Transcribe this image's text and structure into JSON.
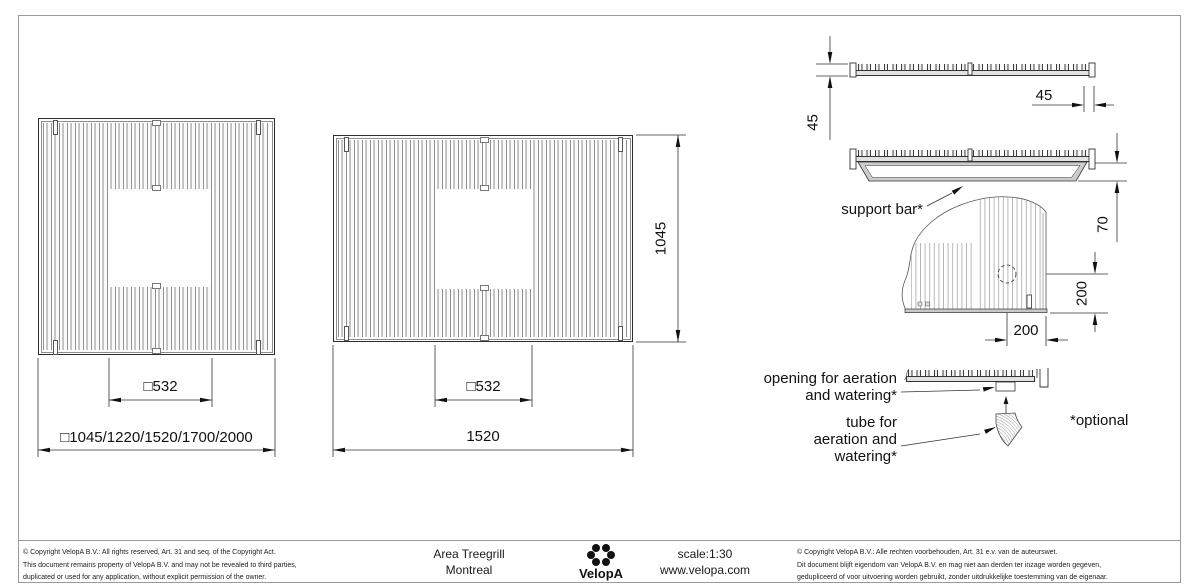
{
  "drawing": {
    "square_grill": {
      "inner_dim": "□532",
      "outer_dim": "□1045/1220/1520/1700/2000"
    },
    "rect_grill": {
      "inner_dim": "□532",
      "width_dim": "1520",
      "height_dim": "1045"
    },
    "profile": {
      "height_dim": "45",
      "edge_dim": "45",
      "assembly_height_dim": "70",
      "support_label": "support bar*"
    },
    "corner_detail": {
      "vertical_dim": "200",
      "horizontal_dim": "200"
    },
    "aeration_detail": {
      "opening_label_lines": [
        "opening for aeration",
        "and watering*"
      ],
      "tube_label_lines": [
        "tube for",
        "aeration and",
        "watering*"
      ],
      "optional_note": "*optional"
    }
  },
  "title_block": {
    "copyright_en_lines": [
      "©  Copyright VelopA B.V.: All rights reserved, Art. 31 and seq. of the Copyright Act.",
      "This document remains property of VelopA B.V. and may not be revealed to third parties,",
      "duplicated or used for any application, without explicit permission of the owner."
    ],
    "product": {
      "line1": "Area Treegrill",
      "line2": "Montreal"
    },
    "brand": "VelopA",
    "scale": "scale:1:30",
    "website": "www.velopa.com",
    "copyright_nl_lines": [
      "©  Copyright VelopA B.V.: Alle rechten voorbehouden, Art. 31 e.v. van de auteurswet.",
      "Dit document blijft eigendom van VelopA B.V. en mag niet aan derden ter inzage worden gegeven,",
      "gedupliceerd of voor uitvoering worden gebruikt, zonder uitdrukkelijke toestemming van de eigenaar."
    ]
  }
}
